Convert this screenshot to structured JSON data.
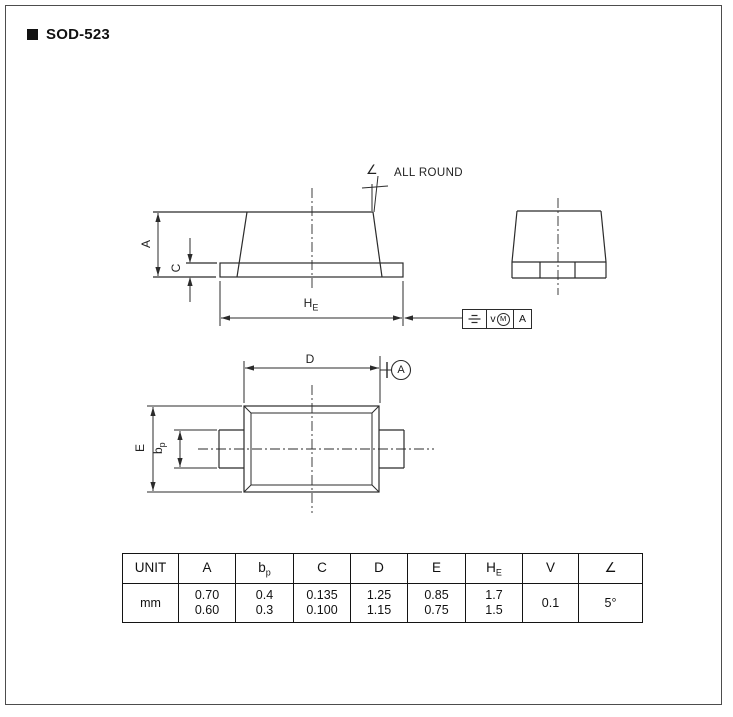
{
  "window": {
    "title": "SOD-523"
  },
  "colors": {
    "line": "#2b2b2b",
    "text": "#111111",
    "page_border": "#4d4d4d",
    "background": "#ffffff"
  },
  "callout": {
    "angle_symbol": "∠",
    "label": "ALL ROUND"
  },
  "side_view": {
    "dim_a": "A",
    "dim_c": "C",
    "dim_he_base": "H",
    "dim_he_sub": "E"
  },
  "end_view": {},
  "top_view": {
    "dim_d": "D",
    "dim_e": "E",
    "dim_bp_base": "b",
    "dim_bp_sub": "p",
    "datum": "A"
  },
  "fcf": {
    "symbol_icon": "symmetry-icon",
    "tolerance": "v",
    "modifier": "M",
    "datum": "A"
  },
  "table": {
    "headers": [
      {
        "t": "UNIT",
        "sub": ""
      },
      {
        "t": "A",
        "sub": ""
      },
      {
        "t": "b",
        "sub": "p"
      },
      {
        "t": "C",
        "sub": ""
      },
      {
        "t": "D",
        "sub": ""
      },
      {
        "t": "E",
        "sub": ""
      },
      {
        "t": "H",
        "sub": "E"
      },
      {
        "t": "V",
        "sub": ""
      },
      {
        "t": "∠",
        "sub": ""
      }
    ],
    "rows": [
      {
        "cells": [
          [
            "mm"
          ],
          [
            "0.70",
            "0.60"
          ],
          [
            "0.4",
            "0.3"
          ],
          [
            "0.135",
            "0.100"
          ],
          [
            "1.25",
            "1.15"
          ],
          [
            "0.85",
            "0.75"
          ],
          [
            "1.7",
            "1.5"
          ],
          [
            "0.1"
          ],
          [
            "5°"
          ]
        ]
      }
    ]
  }
}
